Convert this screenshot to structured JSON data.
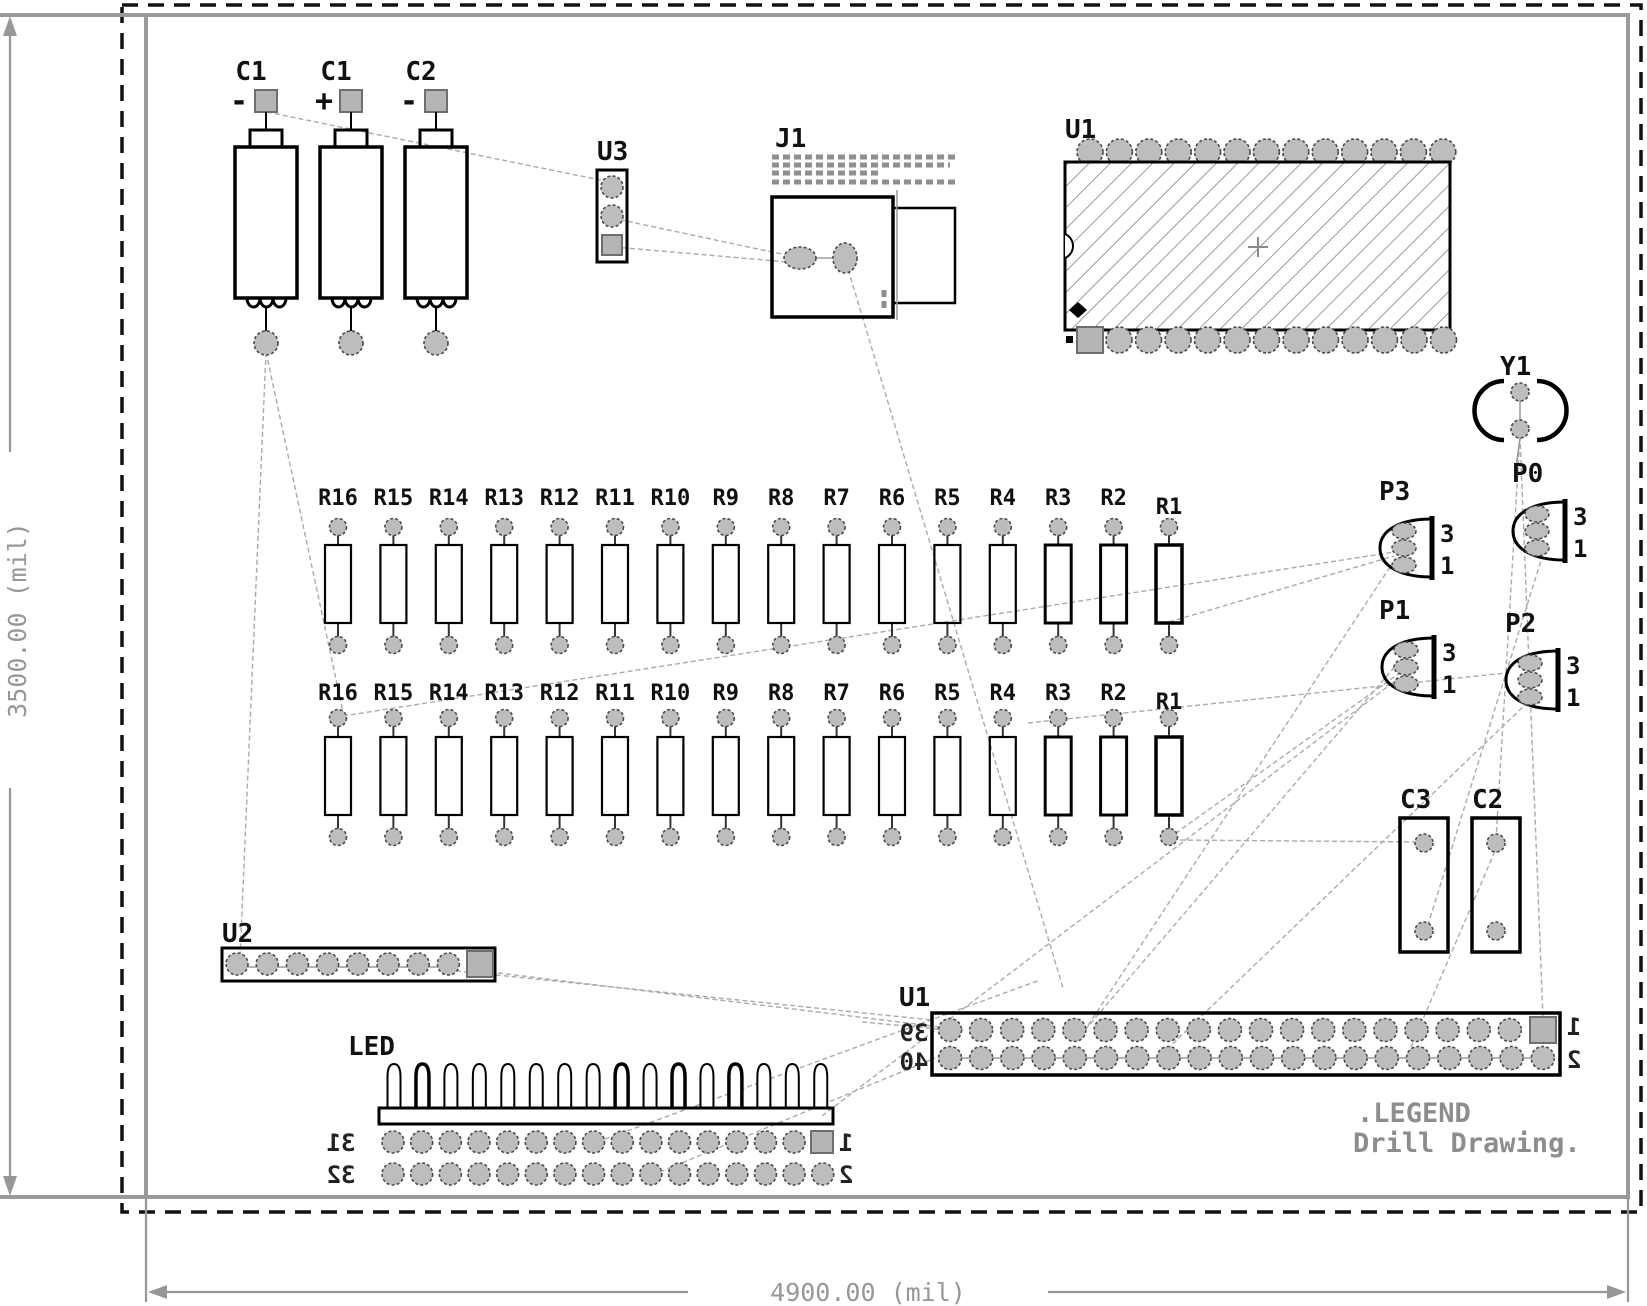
{
  "drawing": {
    "legend_title": ".LEGEND",
    "legend_subtitle": "Drill Drawing.",
    "dim_height": "3500.00 (mil)",
    "dim_width": "4900.00 (mil)"
  },
  "capacitors": {
    "c1a": {
      "ref": "C1",
      "polarity": "-"
    },
    "c1b": {
      "ref": "C1",
      "polarity": "+"
    },
    "c2": {
      "ref": "C2",
      "polarity": "-"
    }
  },
  "u3": {
    "ref": "U3"
  },
  "j1": {
    "ref": "J1"
  },
  "u1_ic": {
    "ref": "U1"
  },
  "y1": {
    "ref": "Y1"
  },
  "resistors": {
    "row1": [
      "R16",
      "R15",
      "R14",
      "R13",
      "R12",
      "R11",
      "R10",
      "R9",
      "R8",
      "R7",
      "R6",
      "R5",
      "R4",
      "R3",
      "R2",
      "R1"
    ],
    "row2": [
      "R16",
      "R15",
      "R14",
      "R13",
      "R12",
      "R11",
      "R10",
      "R9",
      "R8",
      "R7",
      "R6",
      "R5",
      "R4",
      "R3",
      "R2",
      "R1"
    ]
  },
  "headers": {
    "p3": {
      "ref": "P3",
      "pin_top": "3",
      "pin_bottom": "1"
    },
    "p0": {
      "ref": "P0",
      "pin_top": "3",
      "pin_bottom": "1"
    },
    "p1": {
      "ref": "P1",
      "pin_top": "3",
      "pin_bottom": "1"
    },
    "p2": {
      "ref": "P2",
      "pin_top": "3",
      "pin_bottom": "1"
    }
  },
  "right_caps": {
    "c3": {
      "ref": "C3"
    },
    "c2": {
      "ref": "C2"
    }
  },
  "u2": {
    "ref": "U2"
  },
  "led": {
    "ref": "LED",
    "pin_row1_left": "31",
    "pin_row2_left": "32",
    "pin_row1_right": "1",
    "pin_row2_right": "2"
  },
  "u1_connector": {
    "ref": "U1",
    "pin_row1_left": "39",
    "pin_row2_left": "40",
    "pin_row1_right": "1",
    "pin_row2_right": "2"
  }
}
